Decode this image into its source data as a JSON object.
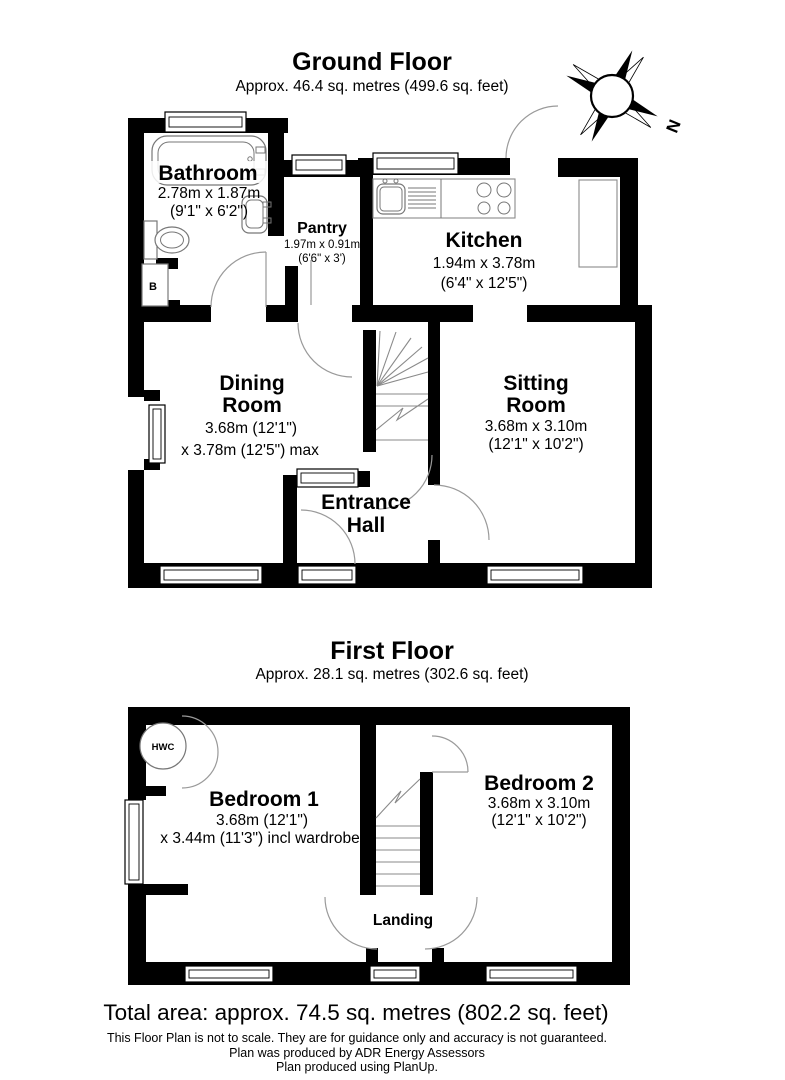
{
  "ground_floor": {
    "title": "Ground Floor",
    "area": "Approx. 46.4 sq. metres (499.6 sq. feet)",
    "rooms": {
      "bathroom": {
        "name": "Bathroom",
        "metric": "2.78m x 1.87m",
        "imperial": "(9'1\" x 6'2\")"
      },
      "pantry": {
        "name": "Pantry",
        "metric": "1.97m x 0.91m",
        "imperial": "(6'6\" x 3')"
      },
      "kitchen": {
        "name": "Kitchen",
        "metric": "1.94m x 3.78m",
        "imperial": "(6'4\" x 12'5\")"
      },
      "dining_room": {
        "name1": "Dining",
        "name2": "Room",
        "metric": "3.68m (12'1\")",
        "imperial": "x 3.78m (12'5\") max"
      },
      "sitting_room": {
        "name1": "Sitting",
        "name2": "Room",
        "metric": "3.68m x 3.10m",
        "imperial": "(12'1\" x 10'2\")"
      },
      "entrance_hall": {
        "name1": "Entrance",
        "name2": "Hall"
      }
    },
    "boiler_label": "B"
  },
  "first_floor": {
    "title": "First Floor",
    "area": "Approx. 28.1 sq. metres (302.6 sq. feet)",
    "rooms": {
      "bedroom1": {
        "name": "Bedroom 1",
        "metric": "3.68m (12'1\")",
        "imperial": "x 3.44m (11'3\") incl wardrobe"
      },
      "bedroom2": {
        "name": "Bedroom 2",
        "metric": "3.68m x 3.10m",
        "imperial": "(12'1\" x 10'2\")"
      },
      "landing": {
        "name": "Landing"
      }
    },
    "hwc_label": "HWC"
  },
  "compass": {
    "north": "N"
  },
  "footer": {
    "total_area": "Total area: approx. 74.5 sq. metres (802.2 sq. feet)",
    "line1": "This Floor Plan is not to scale. They are for guidance only and accuracy is not guaranteed.",
    "line2": "Plan was produced by ADR Energy Assessors",
    "line3": "Plan produced using PlanUp."
  },
  "colors": {
    "wall": "#000000",
    "background": "#ffffff",
    "door_arc": "#9a9a9a"
  }
}
